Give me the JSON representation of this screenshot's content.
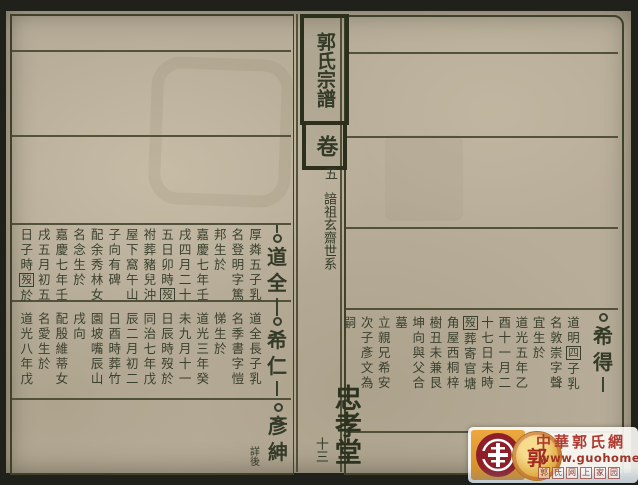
{
  "book": {
    "title": "郭氏宗譜",
    "volume_label": "卷",
    "volume_number": "五",
    "section_title": "諳祖玄齋世系",
    "leaf_number": "十三",
    "hall_name": "忠孝堂"
  },
  "right_page": {
    "entry": {
      "name": "希得",
      "line_above": false,
      "line_below": true,
      "columns": [
        "道明⟦四⟧子乳",
        "名敦崇字聲",
        "宜生於",
        "道光五年乙",
        "酉十一月二",
        "十七日未時",
        "⟦歿⟧葬寄官塘",
        "角屋西桐梓",
        "樹丑未兼艮",
        "坤向與父合",
        "墓",
        "立親兄希安",
        "次子彥文為",
        "嗣"
      ]
    }
  },
  "left_page": {
    "entries": [
      {
        "name": "道全",
        "line_above": true,
        "line_below": true,
        "columns": [
          "厚粦五子乳",
          "名登明字篤",
          "邦生於",
          "嘉慶七年壬",
          "戌四月二十",
          "五日卯時⟦歿⟧",
          "祔葬豬兒沖",
          "屋下窩午山",
          "子向有碑",
          "配余秀林女",
          "名念生於",
          "嘉慶七年壬",
          "戌五月初五",
          "日子時⟦歿⟧於"
        ]
      },
      {
        "name": "希仁",
        "line_above": true,
        "line_below": true,
        "columns": [
          "道全長子乳",
          "名季書字愷",
          "悌生於",
          "道光三年癸",
          "未九月十一",
          "日辰時歿於",
          "同治七年戊",
          "辰二月初二",
          "日酉時葬竹",
          "園坡嘴辰山",
          "戌向",
          "配殷維蒂女",
          "名愛生於",
          "道光八年戊"
        ]
      },
      {
        "name": "彥紳",
        "line_above": false,
        "line_below": false,
        "note": "詳後",
        "columns": []
      }
    ]
  },
  "watermark_banner": {
    "site_name": "中華郭氏網",
    "site_url": "www.guohome.org",
    "slogan": "郭氏网上家园",
    "seal_character": "郭",
    "colors": {
      "red": "#b03a30",
      "deep_red": "#8e1f28",
      "gold": "#d9a43c"
    }
  }
}
